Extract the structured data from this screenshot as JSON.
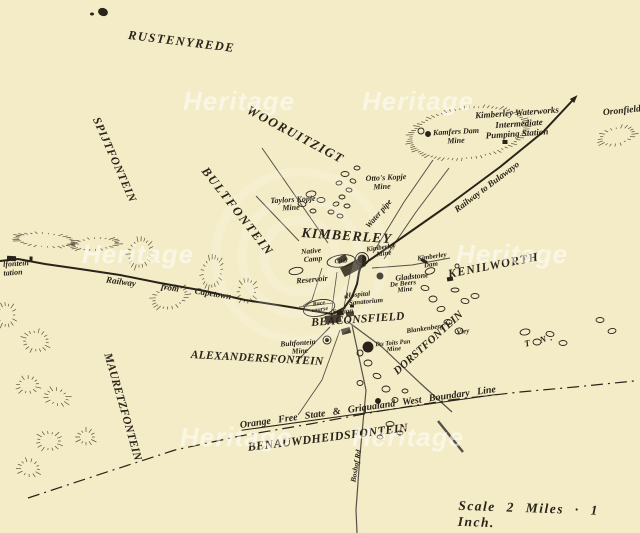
{
  "map": {
    "scale_label": "Scale 2 Miles · 1 Inch.",
    "north_label": "T N.",
    "watermark": {
      "text": "Heritage",
      "positions": [
        [
          183,
          88
        ],
        [
          362,
          88
        ],
        [
          82,
          241
        ],
        [
          456,
          241
        ],
        [
          180,
          424
        ],
        [
          352,
          424
        ]
      ]
    },
    "colors": {
      "paper": "#f3ecc6",
      "ink": "#29231a",
      "ink_soft": "#4a4232",
      "watermark_ring": "rgba(255,255,255,0.16)"
    },
    "region_labels": [
      {
        "t": "RUSTENYREDE",
        "x": 129,
        "y": 29,
        "r": 7,
        "s": 12.5,
        "sp": 1.5
      },
      {
        "t": "WOORUITZIGT",
        "x": 251,
        "y": 103,
        "r": 28,
        "s": 13,
        "sp": 1.5
      },
      {
        "t": "SPIJTFONTEIN",
        "x": 100,
        "y": 116,
        "r": 66,
        "s": 11.5,
        "sp": 0.8
      },
      {
        "t": "BULTFONTEIN",
        "x": 209,
        "y": 165,
        "r": 52,
        "s": 12.5,
        "sp": 1.8
      },
      {
        "t": "KIMBERLEY",
        "x": 302,
        "y": 227,
        "r": 4,
        "s": 14,
        "sp": 1
      },
      {
        "t": "KENILWORTH",
        "x": 447,
        "y": 268,
        "r": -11,
        "s": 12,
        "sp": 1.2
      },
      {
        "t": "BEACONSFIELD",
        "x": 311,
        "y": 318,
        "r": -4,
        "s": 11.5,
        "sp": 0.4
      },
      {
        "t": "ALEXANDERSFONTEIN",
        "x": 191,
        "y": 350,
        "r": 3,
        "s": 11.5,
        "sp": 0.3
      },
      {
        "t": "MAURETZFONTEIN",
        "x": 112,
        "y": 352,
        "r": 74,
        "s": 11.5,
        "sp": 0.3
      },
      {
        "t": "DORSTFONTEIN",
        "x": 392,
        "y": 369,
        "r": -42,
        "s": 11,
        "sp": 0.3
      },
      {
        "t": "BENAUWDHEIDSFONTEIN",
        "x": 247,
        "y": 441,
        "r": -7,
        "s": 12,
        "sp": 0.5
      }
    ],
    "place_labels": [
      {
        "t": "Kimberley Waterworks",
        "x": 517,
        "y": 113,
        "r": -4,
        "s": 9
      },
      {
        "t": "Intermediate",
        "x": 519,
        "y": 124,
        "r": -4,
        "s": 9
      },
      {
        "t": "Pumping Station",
        "x": 517,
        "y": 134,
        "r": -4,
        "s": 9
      },
      {
        "t": "Kamfers Dam",
        "x": 456,
        "y": 132,
        "r": -3,
        "s": 8
      },
      {
        "t": "Mine",
        "x": 456,
        "y": 141,
        "r": -3,
        "s": 8
      },
      {
        "t": "Oronfield",
        "x": 622,
        "y": 112,
        "r": -6,
        "s": 9.5
      },
      {
        "t": "Otto's Kopje",
        "x": 386,
        "y": 178,
        "r": -3,
        "s": 8
      },
      {
        "t": "Mine",
        "x": 382,
        "y": 187,
        "r": -3,
        "s": 8
      },
      {
        "t": "Taylors Kopje",
        "x": 293,
        "y": 200,
        "r": -3,
        "s": 8
      },
      {
        "t": "Mine",
        "x": 291,
        "y": 208,
        "r": -3,
        "s": 8
      },
      {
        "t": "Water pipe",
        "x": 379,
        "y": 214,
        "r": -49,
        "s": 8
      },
      {
        "t": "Railway to Bulawayo",
        "x": 487,
        "y": 187,
        "r": -37,
        "s": 9
      },
      {
        "t": "Railway",
        "x": 121,
        "y": 282,
        "r": 8,
        "s": 9
      },
      {
        "t": "from",
        "x": 170,
        "y": 288,
        "r": 9,
        "s": 9
      },
      {
        "t": "Capetown",
        "x": 213,
        "y": 294,
        "r": 9,
        "s": 9
      },
      {
        "t": "lfontein",
        "x": 16,
        "y": 264,
        "r": -4,
        "s": 8
      },
      {
        "t": "tation",
        "x": 13,
        "y": 273,
        "r": -4,
        "s": 8
      },
      {
        "t": "Native",
        "x": 311,
        "y": 251,
        "r": -5,
        "s": 7.5
      },
      {
        "t": "Camp",
        "x": 313,
        "y": 259,
        "r": -5,
        "s": 7.5
      },
      {
        "t": "Club",
        "x": 341,
        "y": 262,
        "r": -5,
        "s": 6.5
      },
      {
        "t": "Reservoir",
        "x": 312,
        "y": 280,
        "r": -5,
        "s": 8
      },
      {
        "t": "Kimberley",
        "x": 381,
        "y": 248,
        "r": -8,
        "s": 7
      },
      {
        "t": "Mine",
        "x": 384,
        "y": 254,
        "r": -8,
        "s": 7
      },
      {
        "t": "Gladstone",
        "x": 412,
        "y": 277,
        "r": -6,
        "s": 8
      },
      {
        "t": "De Beers",
        "x": 403,
        "y": 284,
        "r": -6,
        "s": 7
      },
      {
        "t": "Mine",
        "x": 405,
        "y": 290,
        "r": -6,
        "s": 7
      },
      {
        "t": "Kimberley",
        "x": 432,
        "y": 257,
        "r": -8,
        "s": 7
      },
      {
        "t": "Dam",
        "x": 431,
        "y": 265,
        "r": -8,
        "s": 7
      },
      {
        "t": "Hospital",
        "x": 358,
        "y": 295,
        "r": -5,
        "s": 7
      },
      {
        "t": "Sanatorium",
        "x": 366,
        "y": 302,
        "r": -5,
        "s": 7
      },
      {
        "t": "Race",
        "x": 319,
        "y": 304,
        "r": -8,
        "s": 6
      },
      {
        "t": "course",
        "x": 320,
        "y": 310,
        "r": -8,
        "s": 6
      },
      {
        "t": "Station",
        "x": 343,
        "y": 312,
        "r": -5,
        "s": 7
      },
      {
        "t": "Blankenberg",
        "x": 425,
        "y": 329,
        "r": -8,
        "s": 7
      },
      {
        "t": "Vley",
        "x": 463,
        "y": 332,
        "r": -8,
        "s": 7
      },
      {
        "t": "Bultfontein",
        "x": 298,
        "y": 343,
        "r": -4,
        "s": 7.5
      },
      {
        "t": "Mine",
        "x": 300,
        "y": 351,
        "r": -4,
        "s": 7.5
      },
      {
        "t": "Du Toits Pan",
        "x": 393,
        "y": 344,
        "r": -5,
        "s": 6.5
      },
      {
        "t": "Mine",
        "x": 394,
        "y": 350,
        "r": -5,
        "s": 6.5
      },
      {
        "t": "Boshof Rd",
        "x": 356,
        "y": 466,
        "r": -80,
        "s": 7.5
      },
      {
        "t": "Orange Free State & Griqualand West Boundary Line",
        "x": 368,
        "y": 408,
        "r": -8,
        "s": 10,
        "u": true,
        "ws": 5
      }
    ]
  },
  "geometry": {
    "railways": [
      {
        "pts": [
          [
            0,
            261
          ],
          [
            18,
            259
          ],
          [
            45,
            264
          ],
          [
            80,
            269
          ],
          [
            120,
            275
          ],
          [
            160,
            283
          ],
          [
            205,
            291
          ],
          [
            245,
            300
          ],
          [
            290,
            307
          ],
          [
            332,
            314
          ]
        ],
        "w": 2
      },
      {
        "pts": [
          [
            332,
            314
          ],
          [
            344,
            308
          ],
          [
            352,
            297
          ],
          [
            357,
            284
          ],
          [
            359,
            272
          ],
          [
            361,
            266
          ]
        ],
        "w": 2
      },
      {
        "pts": [
          [
            361,
            266
          ],
          [
            400,
            239
          ],
          [
            450,
            204
          ],
          [
            500,
            167
          ],
          [
            543,
            132
          ],
          [
            572,
            101
          ]
        ],
        "w": 2,
        "arrow": true
      }
    ],
    "roads": [
      {
        "pts": [
          [
            262,
            148
          ],
          [
            328,
            243
          ]
        ],
        "w": 1
      },
      {
        "pts": [
          [
            256,
            196
          ],
          [
            299,
            241
          ]
        ],
        "w": 1
      },
      {
        "pts": [
          [
            433,
            160
          ],
          [
            404,
            202
          ],
          [
            373,
            253
          ]
        ],
        "w": 1
      },
      {
        "pts": [
          [
            449,
            168
          ],
          [
            416,
            212
          ],
          [
            384,
            259
          ]
        ],
        "w": 1
      },
      {
        "pts": [
          [
            372,
            268
          ],
          [
            412,
            265
          ],
          [
            450,
            258
          ]
        ],
        "w": 1
      },
      {
        "pts": [
          [
            347,
            321
          ],
          [
            382,
            347
          ],
          [
            420,
            383
          ],
          [
            452,
            412
          ]
        ],
        "w": 1.2
      },
      {
        "pts": [
          [
            438,
            421
          ],
          [
            463,
            452
          ]
        ],
        "w": 2.4
      },
      {
        "pts": [
          [
            352,
            325
          ],
          [
            366,
            390
          ],
          [
            360,
            455
          ],
          [
            356,
            510
          ],
          [
            357,
            533
          ]
        ],
        "w": 1.2
      },
      {
        "pts": [
          [
            330,
            327
          ],
          [
            296,
            362
          ]
        ],
        "w": 1
      },
      {
        "pts": [
          [
            340,
            330
          ],
          [
            322,
            380
          ],
          [
            298,
            415
          ]
        ],
        "w": 0.9
      },
      {
        "pts": [
          [
            337,
            272
          ],
          [
            331,
            316
          ]
        ],
        "w": 0.8
      },
      {
        "pts": [
          [
            350,
            274
          ],
          [
            343,
            313
          ]
        ],
        "w": 0.8
      },
      {
        "pts": [
          [
            322,
            268
          ],
          [
            312,
            300
          ],
          [
            303,
            306
          ]
        ],
        "w": 0.8
      },
      {
        "pts": [
          [
            299,
            307
          ],
          [
            333,
            303
          ]
        ],
        "w": 0.8
      }
    ],
    "boundary": {
      "pts": [
        [
          28,
          498
        ],
        [
          110,
          471
        ],
        [
          175,
          450
        ],
        [
          240,
          436
        ],
        [
          310,
          424
        ],
        [
          380,
          411
        ],
        [
          450,
          400
        ],
        [
          520,
          392
        ],
        [
          575,
          387
        ],
        [
          634,
          381
        ]
      ],
      "dash": "12 5 2 5",
      "w": 1.2
    },
    "hills": [
      [
        468,
        133,
        56,
        24,
        -8
      ],
      [
        617,
        136,
        15,
        7,
        -15
      ],
      [
        45,
        240,
        26,
        6,
        4
      ],
      [
        95,
        244,
        20,
        5,
        -4
      ],
      [
        140,
        253,
        9,
        12,
        18
      ],
      [
        212,
        272,
        8,
        13,
        12
      ],
      [
        170,
        297,
        15,
        9,
        -18
      ],
      [
        6,
        315,
        7,
        9,
        0
      ],
      [
        247,
        291,
        7,
        9,
        10
      ],
      [
        36,
        341,
        10,
        8,
        8
      ],
      [
        28,
        385,
        8,
        6,
        -8
      ],
      [
        57,
        397,
        9,
        6,
        15
      ],
      [
        49,
        441,
        9,
        7,
        0
      ],
      [
        29,
        468,
        8,
        6,
        8
      ],
      [
        86,
        437,
        6,
        5,
        0
      ]
    ],
    "ponds": [
      [
        345,
        174,
        4,
        2.5,
        0
      ],
      [
        353,
        181,
        3,
        2,
        20
      ],
      [
        339,
        183,
        3,
        2,
        -10
      ],
      [
        357,
        168,
        3,
        2,
        0
      ],
      [
        349,
        190,
        3,
        2,
        10
      ],
      [
        342,
        197,
        3,
        2,
        0
      ],
      [
        336,
        204,
        3,
        2,
        -15
      ],
      [
        347,
        206,
        3,
        2,
        0
      ],
      [
        331,
        212,
        3,
        2,
        0
      ],
      [
        340,
        216,
        3,
        2,
        10
      ],
      [
        311,
        194,
        5,
        3,
        -10
      ],
      [
        321,
        200,
        4,
        2.5,
        0
      ],
      [
        302,
        204,
        4,
        2.5,
        10
      ],
      [
        313,
        211,
        3,
        2,
        0
      ],
      [
        430,
        271,
        5,
        3,
        -20
      ],
      [
        425,
        288,
        4,
        2.5,
        10
      ],
      [
        433,
        299,
        4,
        3,
        0
      ],
      [
        441,
        309,
        4,
        2.5,
        -10
      ],
      [
        455,
        290,
        4,
        2,
        0
      ],
      [
        465,
        301,
        4,
        2.5,
        10
      ],
      [
        448,
        322,
        4,
        2.5,
        0
      ],
      [
        459,
        331,
        4,
        3,
        -10
      ],
      [
        368,
        363,
        4,
        3,
        0
      ],
      [
        377,
        376,
        4,
        2.5,
        15
      ],
      [
        386,
        389,
        4,
        3,
        0
      ],
      [
        360,
        383,
        3,
        2.5,
        0
      ],
      [
        395,
        400,
        3,
        2.5,
        0
      ],
      [
        405,
        391,
        3,
        2,
        0
      ],
      [
        525,
        332,
        5,
        3,
        -10
      ],
      [
        537,
        342,
        4,
        3,
        0
      ],
      [
        550,
        334,
        4,
        2.5,
        10
      ],
      [
        563,
        343,
        4,
        2.5,
        0
      ],
      [
        600,
        320,
        4,
        2.5,
        0
      ],
      [
        612,
        331,
        4,
        2.5,
        -10
      ],
      [
        390,
        424,
        4,
        2.5,
        0
      ],
      [
        400,
        433,
        3,
        2,
        0
      ],
      [
        380,
        437,
        3,
        2,
        10
      ],
      [
        341,
        261,
        14,
        6,
        -8
      ],
      [
        319,
        308,
        16,
        8,
        -12
      ],
      [
        296,
        271,
        7,
        3.5,
        -10
      ],
      [
        475,
        296,
        4,
        2.5,
        0
      ]
    ],
    "blocks": [
      [
        353,
        267,
        24,
        10,
        -28
      ],
      [
        342,
        259,
        10,
        6,
        -28
      ],
      [
        333,
        319,
        16,
        8,
        -8
      ],
      [
        350,
        314,
        8,
        5,
        -8
      ],
      [
        346,
        331,
        9,
        6,
        -15
      ]
    ],
    "markers": [
      [
        11.5,
        258.5,
        9,
        5,
        3
      ],
      [
        31,
        259,
        3,
        5,
        3
      ],
      [
        340,
        313,
        7,
        5,
        -5
      ],
      [
        505,
        142,
        5,
        4,
        0
      ],
      [
        352,
        306,
        4,
        3,
        0
      ],
      [
        346,
        297,
        3,
        3,
        0
      ],
      [
        424,
        261,
        7,
        3,
        28
      ],
      [
        450,
        279,
        6,
        4,
        -10
      ]
    ],
    "mines": [
      [
        362,
        259,
        4,
        1
      ],
      [
        362,
        259,
        6.5,
        0
      ],
      [
        380,
        276,
        3,
        1
      ],
      [
        428,
        134,
        2.5,
        1
      ],
      [
        421,
        131,
        3,
        0
      ],
      [
        327,
        340,
        4,
        0
      ],
      [
        327,
        340,
        1.5,
        1
      ],
      [
        368,
        347,
        5,
        1
      ],
      [
        360,
        353,
        3,
        0
      ],
      [
        378,
        401,
        2.5,
        1
      ],
      [
        457,
        266,
        2,
        0
      ]
    ],
    "blobs": [
      [
        103,
        12,
        5,
        4,
        20
      ],
      [
        92,
        14,
        2,
        1.5,
        0
      ]
    ],
    "rings": [
      [
        300,
        256,
        36
      ],
      [
        300,
        256,
        58
      ],
      [
        300,
        256,
        84
      ]
    ]
  }
}
